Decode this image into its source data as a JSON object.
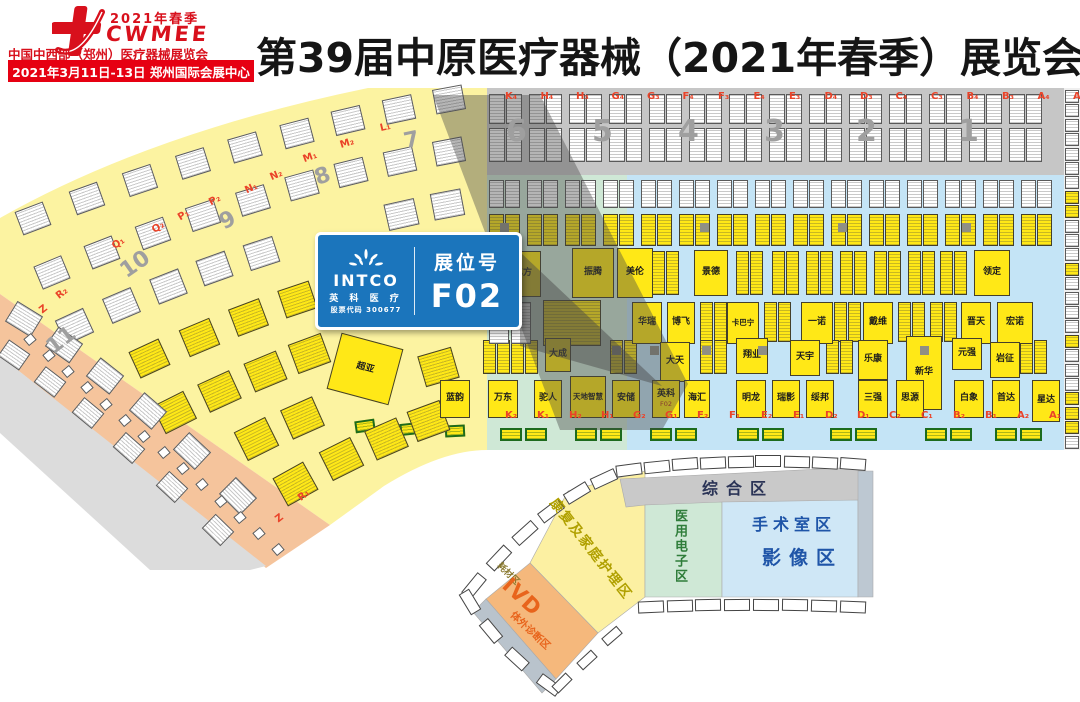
{
  "header": {
    "logo_season": "2021年春季",
    "logo_acronym": "CWMEE",
    "logo_name": "中国中西部（郑州）医疗器械展览会",
    "banner": "2021年3月11日-13日  郑州国际会展中心",
    "title": "第39届中原医疗器械（2021年春季）展览会"
  },
  "callout": {
    "brand": "INTCO",
    "brand_cn": "英 科 医 疗",
    "stock": "股票代码 300677",
    "booth_label": "展位号",
    "booth_no": "F02",
    "accent_color": "#1b75bc"
  },
  "map": {
    "letters_top": [
      "K₄",
      "H₄",
      "H₃",
      "G₄",
      "G₃",
      "F₄",
      "F₃",
      "E₄",
      "E₃",
      "D₄",
      "D₃",
      "C₄",
      "C₃",
      "B₄",
      "B₃",
      "A₄",
      "A₃"
    ],
    "gates_top": [
      {
        "n": "6",
        "x": 506
      },
      {
        "n": "5",
        "x": 592
      },
      {
        "n": "4",
        "x": 678
      },
      {
        "n": "3",
        "x": 764
      },
      {
        "n": "2",
        "x": 856
      },
      {
        "n": "1",
        "x": 958
      }
    ],
    "letters_bottom": [
      "K₂",
      "K₁",
      "H₂",
      "H₁",
      "G₂",
      "G₁",
      "F₂",
      "F₁",
      "E₂",
      "E₁",
      "D₂",
      "D₁",
      "C₂",
      "C₁",
      "B₂",
      "B₁",
      "A₂",
      "A₁"
    ],
    "fan_labels": [
      {
        "t": "L₁",
        "x": 380,
        "y": 34,
        "r": -13
      },
      {
        "t": "7",
        "x": 404,
        "y": 40,
        "r": -12,
        "big": true
      },
      {
        "t": "M₂",
        "x": 340,
        "y": 50,
        "r": -17
      },
      {
        "t": "M₁",
        "x": 303,
        "y": 64,
        "r": -20
      },
      {
        "t": "8",
        "x": 315,
        "y": 76,
        "r": -20,
        "big": true
      },
      {
        "t": "N₂",
        "x": 270,
        "y": 82,
        "r": -23
      },
      {
        "t": "N₁",
        "x": 245,
        "y": 95,
        "r": -26
      },
      {
        "t": "P₂",
        "x": 209,
        "y": 107,
        "r": -28
      },
      {
        "t": "9",
        "x": 220,
        "y": 120,
        "r": -28,
        "big": true
      },
      {
        "t": "P₁",
        "x": 178,
        "y": 122,
        "r": -31
      },
      {
        "t": "Q₂",
        "x": 152,
        "y": 134,
        "r": -33
      },
      {
        "t": "Q₁",
        "x": 112,
        "y": 150,
        "r": -35
      },
      {
        "t": "10",
        "x": 120,
        "y": 164,
        "r": -35,
        "big": true
      },
      {
        "t": "R₂",
        "x": 56,
        "y": 200,
        "r": -38
      },
      {
        "t": "Z",
        "x": 40,
        "y": 216,
        "r": -38
      },
      {
        "t": "11",
        "x": 46,
        "y": 240,
        "r": -38,
        "big": true
      },
      {
        "t": "R₁",
        "x": 298,
        "y": 402,
        "r": -38
      },
      {
        "t": "Z",
        "x": 276,
        "y": 425,
        "r": -38
      }
    ],
    "booths": [
      {
        "n": "亿方",
        "x": 505,
        "y": 163,
        "w": 36,
        "h": 46
      },
      {
        "n": "振腾",
        "x": 572,
        "y": 160,
        "w": 42,
        "h": 50
      },
      {
        "n": "美伦",
        "x": 617,
        "y": 160,
        "w": 36,
        "h": 50
      },
      {
        "n": "景德",
        "x": 694,
        "y": 162,
        "w": 34,
        "h": 46
      },
      {
        "n": "领定",
        "x": 974,
        "y": 162,
        "w": 36,
        "h": 46
      },
      {
        "n": "华瑞",
        "x": 632,
        "y": 214,
        "w": 30,
        "h": 42
      },
      {
        "n": "博飞",
        "x": 667,
        "y": 214,
        "w": 28,
        "h": 42
      },
      {
        "n": "卡巴宁",
        "x": 727,
        "y": 214,
        "w": 32,
        "h": 42
      },
      {
        "n": "一诺",
        "x": 801,
        "y": 214,
        "w": 32,
        "h": 42
      },
      {
        "n": "戴维",
        "x": 863,
        "y": 214,
        "w": 30,
        "h": 42
      },
      {
        "n": "晋天",
        "x": 961,
        "y": 214,
        "w": 30,
        "h": 42
      },
      {
        "n": "宏诺",
        "x": 997,
        "y": 214,
        "w": 36,
        "h": 42
      },
      {
        "n": "大成",
        "x": 545,
        "y": 250,
        "w": 26,
        "h": 34
      },
      {
        "n": "大天",
        "x": 660,
        "y": 254,
        "w": 30,
        "h": 40
      },
      {
        "n": "翔业",
        "x": 736,
        "y": 250,
        "w": 32,
        "h": 36
      },
      {
        "n": "天宇",
        "x": 790,
        "y": 252,
        "w": 30,
        "h": 36
      },
      {
        "n": "乐康",
        "x": 858,
        "y": 252,
        "w": 30,
        "h": 40
      },
      {
        "n": "新华",
        "x": 906,
        "y": 248,
        "w": 36,
        "h": 74
      },
      {
        "n": "元强",
        "x": 952,
        "y": 250,
        "w": 30,
        "h": 32
      },
      {
        "n": "岩征",
        "x": 990,
        "y": 254,
        "w": 30,
        "h": 36
      },
      {
        "n": "蓝韵",
        "x": 440,
        "y": 292,
        "w": 30,
        "h": 38
      },
      {
        "n": "万东",
        "x": 488,
        "y": 292,
        "w": 30,
        "h": 38
      },
      {
        "n": "驼人",
        "x": 534,
        "y": 292,
        "w": 28,
        "h": 38
      },
      {
        "n": "天地智慧",
        "x": 570,
        "y": 288,
        "w": 36,
        "h": 42
      },
      {
        "n": "安储",
        "x": 612,
        "y": 292,
        "w": 28,
        "h": 38
      },
      {
        "n": "英科",
        "x": 652,
        "y": 292,
        "w": 28,
        "h": 38,
        "code": "F02"
      },
      {
        "n": "海汇",
        "x": 684,
        "y": 292,
        "w": 26,
        "h": 38
      },
      {
        "n": "明龙",
        "x": 736,
        "y": 292,
        "w": 30,
        "h": 38
      },
      {
        "n": "瑞影",
        "x": 772,
        "y": 292,
        "w": 28,
        "h": 38
      },
      {
        "n": "绥邦",
        "x": 806,
        "y": 292,
        "w": 28,
        "h": 38
      },
      {
        "n": "三强",
        "x": 858,
        "y": 292,
        "w": 30,
        "h": 38
      },
      {
        "n": "思源",
        "x": 896,
        "y": 292,
        "w": 28,
        "h": 38
      },
      {
        "n": "白象",
        "x": 954,
        "y": 292,
        "w": 30,
        "h": 38
      },
      {
        "n": "首达",
        "x": 992,
        "y": 292,
        "w": 28,
        "h": 38
      },
      {
        "n": "星达",
        "x": 1032,
        "y": 292,
        "w": 28,
        "h": 42
      },
      {
        "n": "超亚",
        "x": 333,
        "y": 252,
        "w": 64,
        "h": 58,
        "rot": 15
      }
    ]
  },
  "minimap": {
    "comprehensive": "综合区",
    "operating_room": "手术室区",
    "imaging": "影像区",
    "electronics": "医用电子区",
    "rehab": "康复及家庭护理区",
    "consumables": "耗材区",
    "ivd": "IVD",
    "ivd_sub": "体外诊断区"
  },
  "colors": {
    "brand_red": "#d8101c",
    "banner_red": "#e60012",
    "booth_yellow": "#ffe817",
    "zone_yellow": "#fcf3a1",
    "zone_orange": "#f5c49c",
    "zone_green": "#cfe8d6",
    "zone_blue": "#c4e4f6",
    "zone_gray": "#c6c6c6",
    "callout_blue": "#1b75bc",
    "label_red": "#ea4329"
  }
}
